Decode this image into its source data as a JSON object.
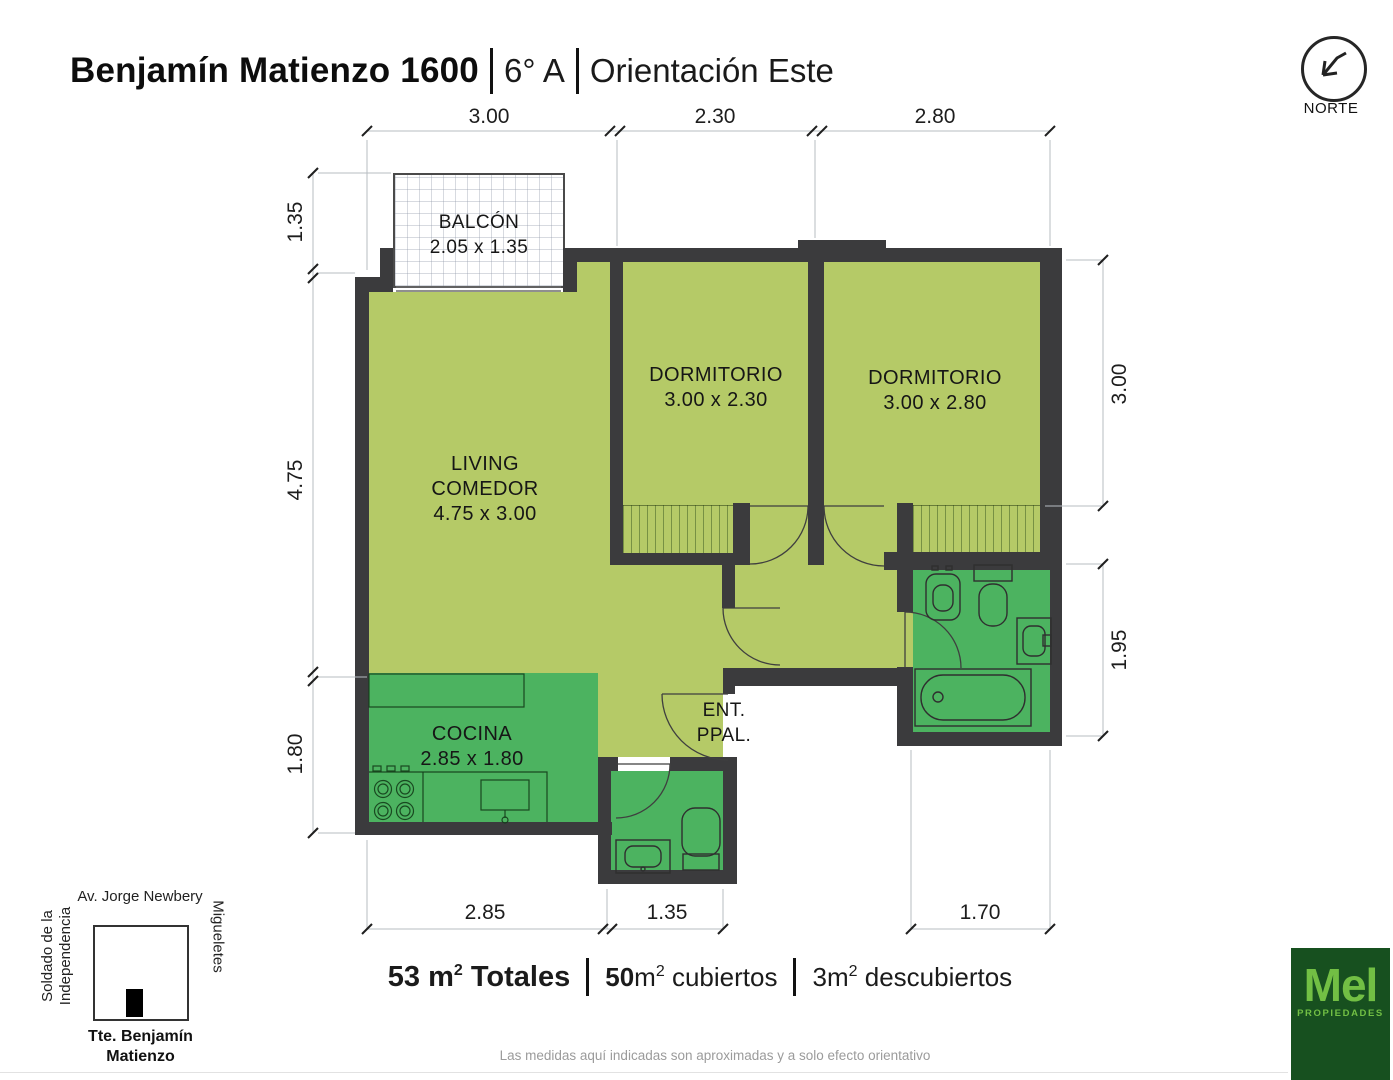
{
  "title": {
    "address": "Benjamín Matienzo 1600",
    "unit": "6° A",
    "orientation": "Orientación Este"
  },
  "north_label": "NORTE",
  "rooms": {
    "balcony": {
      "name": "BALCÓN",
      "size": "2.05 x 1.35"
    },
    "living": {
      "name1": "LIVING",
      "name2": "COMEDOR",
      "size": "4.75 x 3.00"
    },
    "bedroom1": {
      "name": "DORMITORIO",
      "size": "3.00 x 2.30"
    },
    "bedroom2": {
      "name": "DORMITORIO",
      "size": "3.00 x 2.80"
    },
    "kitchen": {
      "name": "COCINA",
      "size": "2.85 x 1.80"
    },
    "entrance": {
      "name1": "ENT.",
      "name2": "PPAL."
    }
  },
  "dimensions": {
    "top": [
      "3.00",
      "2.30",
      "2.80"
    ],
    "left": [
      "1.35",
      "4.75",
      "1.80"
    ],
    "right": [
      "3.00",
      "1.95"
    ],
    "bottom": [
      "2.85",
      "1.35",
      "1.70"
    ]
  },
  "areas": {
    "sup": "2",
    "total_value": "53 m",
    "total_label": " Totales",
    "covered_value": "50",
    "covered_unit": "m",
    "covered_label": " cubiertos",
    "uncovered_value": "3",
    "uncovered_unit": "m",
    "uncovered_label": " descubiertos"
  },
  "map": {
    "top_street": "Av. Jorge Newbery",
    "left_street_line1": "Soldado de la",
    "left_street_line2": "Independencia",
    "right_street": "Migueletes",
    "bottom_street_line1": "Tte. Benjamín",
    "bottom_street_line2": "Matienzo"
  },
  "logo": {
    "name": "Mel",
    "sub": "PROPIEDADES"
  },
  "disclaimer": "Las medidas aquí indicadas son aproximadas y a solo efecto orientativo",
  "colors": {
    "wall": "#3b3b3d",
    "room_light": "#b5ca67",
    "room_wet": "#4cb360",
    "logo_bg": "#17501f",
    "logo_text": "#72bf44"
  }
}
